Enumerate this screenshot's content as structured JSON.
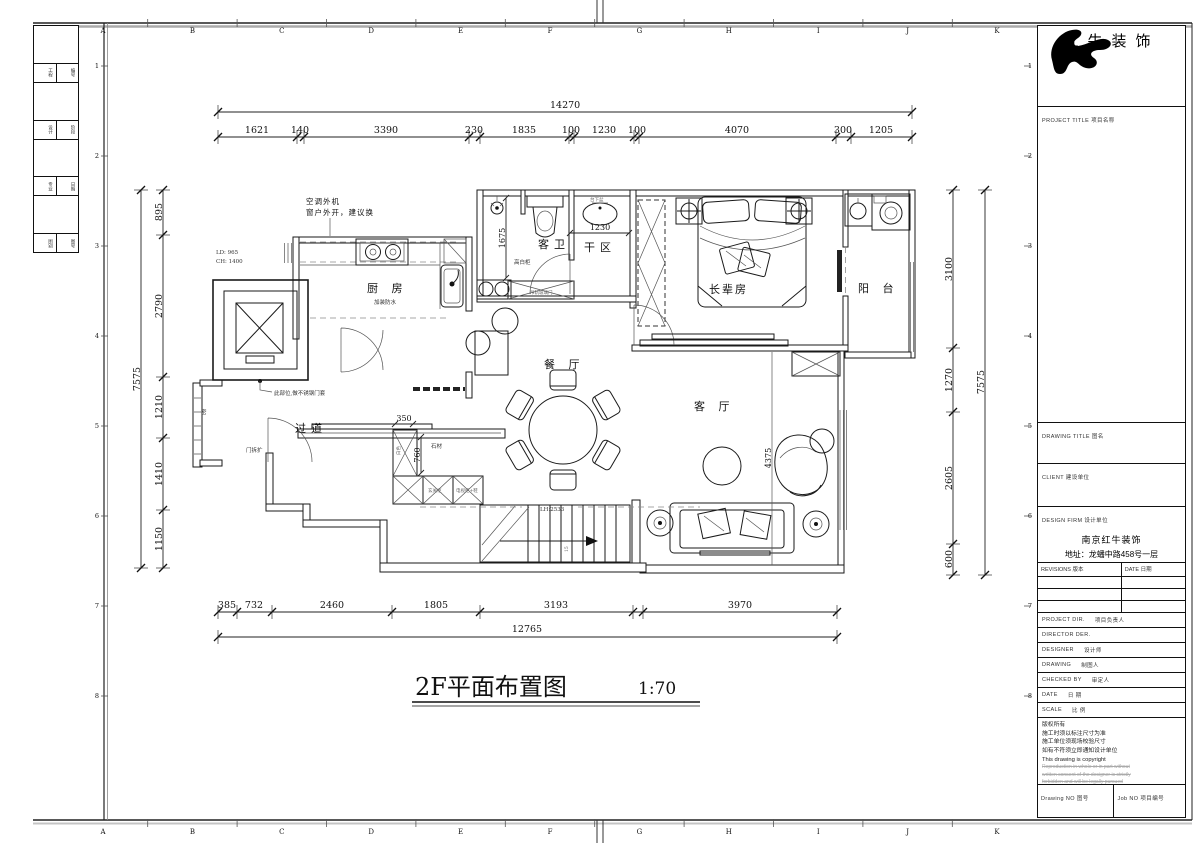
{
  "sheet": {
    "grid_letters": [
      "A",
      "B",
      "C",
      "D",
      "E",
      "F",
      "G",
      "H",
      "I",
      "J",
      "K"
    ],
    "grid_numbers": [
      "1",
      "2",
      "3",
      "4",
      "5",
      "6",
      "7",
      "8"
    ],
    "strip_cells": [
      "工程",
      "编号",
      "设计",
      "阶段",
      "专业",
      "日期",
      "图别",
      "图号"
    ]
  },
  "plan": {
    "title": "2F平面布置图",
    "scale": "1:70",
    "rooms": {
      "kitchen": "厨 房",
      "bath": "客卫",
      "dry_area": "干区",
      "elder_room": "长辈房",
      "balcony": "阳 台",
      "dining": "餐 厅",
      "living": "客 厅",
      "corridor": "过道"
    },
    "annotations": {
      "ac_outdoor": "空调外机",
      "window_note": "窗户外开，建议换",
      "ld": "LD: 965",
      "ch": "CH: 1400",
      "steel_note": "此部位,做不锈钢门套",
      "kitchen_note": "加装防水",
      "tall_cabinet": "高白柜",
      "glass_door": "吊轨玻璃门",
      "basin_note": "台下盆",
      "stone": "石材",
      "white": "白色",
      "door_note": "门拆扩",
      "seal": "密",
      "headroom": "LH:2533",
      "steps": "15",
      "cab1": "玄关柜",
      "cab2": "电视柜+鞋"
    },
    "dims": {
      "top_total": "14270",
      "top_segs": [
        "1621",
        "140",
        "3390",
        "230",
        "1835",
        "100",
        "1230",
        "100",
        "4070",
        "300",
        "1205"
      ],
      "left_total": "7575",
      "left_segs": [
        "895",
        "2790",
        "1210",
        "1410",
        "1150"
      ],
      "right_total": "7575",
      "right_segs": [
        "3100",
        "1270",
        "2605",
        "600"
      ],
      "bottom_total": "12765",
      "bottom_segs": [
        "385",
        "732",
        "2460",
        "1805",
        "3193",
        "3970"
      ],
      "inner": {
        "dry_width": "1230",
        "bath_len": "1675",
        "entry_350": "350",
        "entry_760": "760",
        "living_4375": "4375"
      }
    }
  },
  "title_block": {
    "brand": "红牛装饰",
    "project_title_label": "PROJECT TITLE  项目名称",
    "drawing_title_label": "DRAWING TITLE  图名",
    "client_label": "CLIENT  建设单位",
    "design_firm_label": "DESIGN FIRM  设计单位",
    "design_firm_name": "南京红牛装饰",
    "design_firm_addr": "地址：龙蟠中路458号一层",
    "revisions_label": "REVISIONS  版本",
    "date_label": "DATE  日期",
    "rows": [
      {
        "en": "PROJECT DIR.",
        "cn": "项目负责人"
      },
      {
        "en": "DIRECTOR DER.",
        "cn": ""
      },
      {
        "en": "DESIGNER",
        "cn": "设计师"
      },
      {
        "en": "DRAWING",
        "cn": "制图人"
      },
      {
        "en": "CHECKED BY",
        "cn": "审定人"
      },
      {
        "en": "DATE",
        "cn": "日 期"
      },
      {
        "en": "SCALE",
        "cn": "比 例"
      }
    ],
    "notes": [
      "版权所有",
      "施工时须以标注尺寸为准",
      "施工单位须现场校验尺寸",
      "如有不符须立即通知设计单位",
      "This drawing is copyright"
    ],
    "notes_faint": [
      "Reproduction in whole or in part without",
      "written consent of the designer is strictly",
      "forbidden and will be legally pursued"
    ],
    "drawing_no_label": "Drawing NO  图号",
    "job_no_label": "Job NO  项目编号"
  }
}
